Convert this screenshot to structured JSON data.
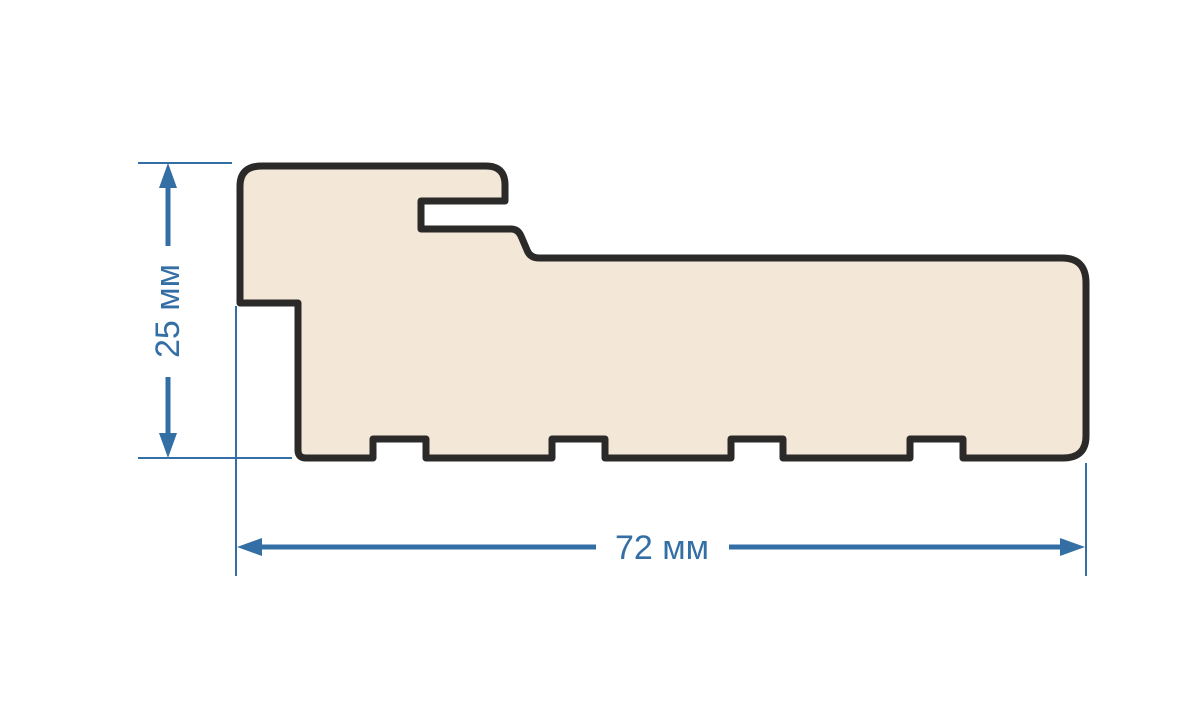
{
  "diagram": {
    "name": "door-frame-profile-cross-section",
    "background": "#ffffff",
    "profile": {
      "description": "profile cross-section shape",
      "fill": "#f3e7d7",
      "outline": "#2b2a29"
    },
    "dimensions": {
      "color": "#336fa4",
      "height": {
        "label": "25 мм",
        "value": 25,
        "unit": "мм",
        "orientation": "vertical"
      },
      "width": {
        "label": "72 мм",
        "value": 72,
        "unit": "мм",
        "orientation": "horizontal"
      }
    }
  }
}
